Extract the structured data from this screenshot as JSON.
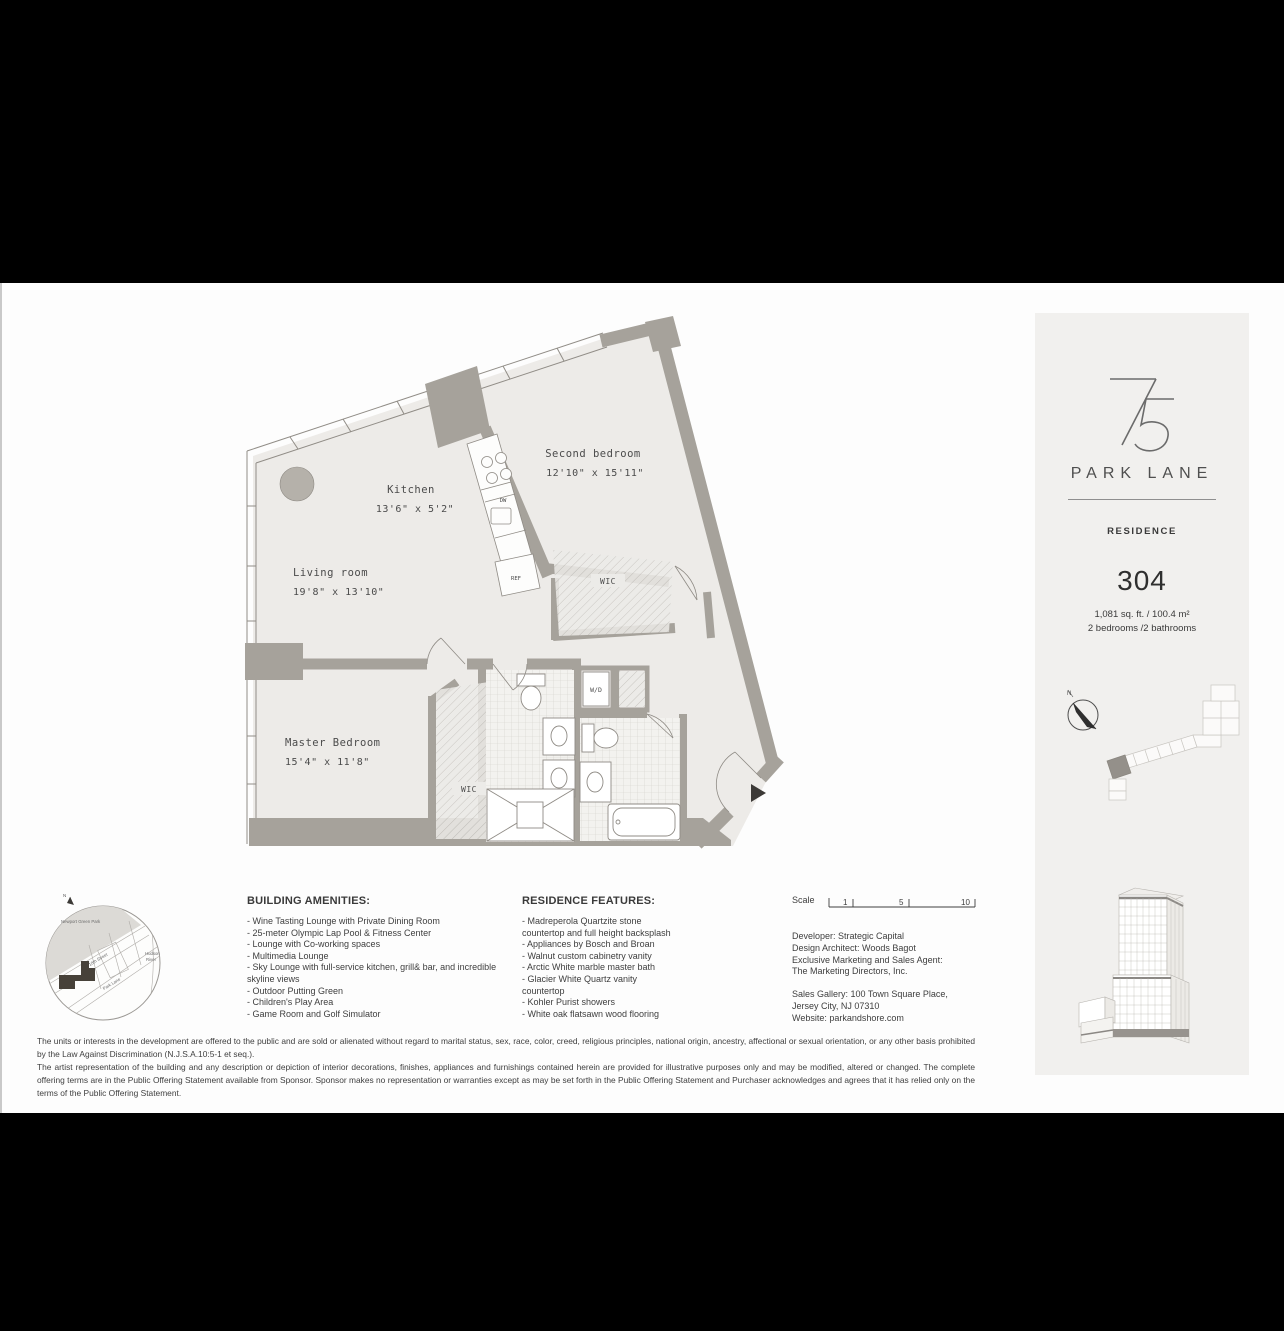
{
  "colors": {
    "frame": "#000000",
    "sheet": "#fdfdfd",
    "card": "#f1f0ee",
    "wall": "#a6a29b",
    "floor": "#edebe8",
    "footprint_dark": "#474139"
  },
  "plan": {
    "rooms": [
      {
        "name": "Living room",
        "dims": "19'8\" x 13'10\""
      },
      {
        "name": "Kitchen",
        "dims": "13'6\" x 5'2\""
      },
      {
        "name": "Second bedroom",
        "dims": "12'10\" x 15'11\""
      },
      {
        "name": "Master Bedroom",
        "dims": "15'4\" x 11'8\""
      }
    ],
    "labels": {
      "wic": "WIC",
      "wic_master": "WIC",
      "wd": "W/D",
      "dw": "DW",
      "ref": "REF"
    }
  },
  "amenities": {
    "title": "BUILDING AMENITIES:",
    "items": [
      "- Wine Tasting Lounge with Private Dining Room",
      "- 25-meter Olympic Lap Pool & Fitness Center",
      "- Lounge with Co-working spaces",
      "- Multimedia Lounge",
      "- Sky Lounge with full-service kitchen, grill& bar, and incredible skyline views",
      "- Outdoor Putting Green",
      "- Children's Play Area",
      "- Game Room and Golf Simulator"
    ]
  },
  "features": {
    "title": "RESIDENCE FEATURES:",
    "items": [
      "- Madreperola Quartzite stone countertop and full height backsplash",
      "- Appliances by Bosch and Broan",
      "- Walnut custom cabinetry vanity",
      "- Arctic White marble master bath",
      "- Glacier White Quartz vanity countertop",
      "- Kohler Purist showers",
      "- White oak flatsawn wood flooring"
    ]
  },
  "scale": {
    "label": "Scale",
    "ticks": [
      "1",
      "5",
      "10"
    ]
  },
  "contact": {
    "lines1": [
      "Developer: Strategic Capital",
      "Design Architect: Woods Bagot",
      "Exclusive Marketing and Sales Agent:",
      "The Marketing Directors, Inc."
    ],
    "lines2": [
      "Sales Gallery: 100 Town Square Place,",
      "Jersey City, NJ 07310",
      "Website: parkandshore.com"
    ]
  },
  "disclaimer": {
    "p1": "The units or interests in the development are offered to the public and are sold or alienated without regard to marital status, sex, race, color, creed, religious principles, national origin, ancestry, affectional or sexual orientation, or any other basis prohibited by the Law Against Discrimination (N.J.S.A.10:5-1 et seq.).",
    "p2": "The artist representation of the building and any description or depiction of interior decorations, finishes, appliances and furnishings contained herein are provided for illustrative purposes only and may be modified, altered or changed. The complete offering terms are in the Public Offering Statement available from Sponsor. Sponsor makes no representation or warranties except as may be set forth in the Public Offering Statement and Purchaser acknowledges and agrees that it has relied only on the terms of the Public Offering Statement."
  },
  "sidebar": {
    "brand": {
      "number": "75",
      "name": "PARK LANE"
    },
    "residence_label": "RESIDENCE",
    "unit_number": "304",
    "area": "1,081 sq. ft. / 100.4 m²",
    "beds_baths": "2 bedrooms /2 bathrooms",
    "compass_n": "N"
  },
  "map": {
    "park": "Newport Green Park",
    "river1": "Hudson",
    "river2": "River",
    "street": "18th Street",
    "lane": "Park Lane",
    "compass_n": "N"
  }
}
